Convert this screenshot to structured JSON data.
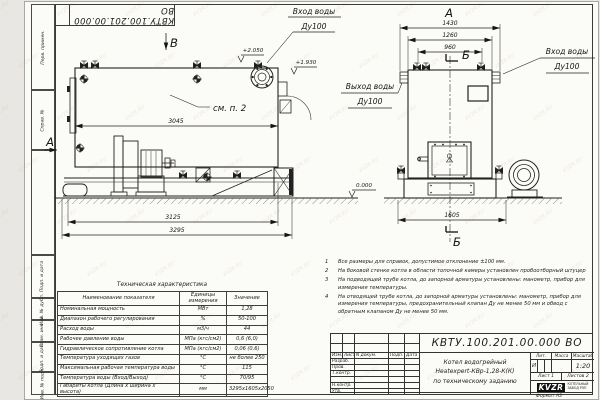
{
  "watermark": {
    "text": "KVZR.RU"
  },
  "frame": {
    "top_stamp": "КВТУ.100.201.00.000 ВО",
    "left_labels": [
      "Перв. примен.",
      "Справ. №",
      "Подп. и дата",
      "Инв. № дубл.",
      "Взам. инв. №",
      "Подп. и дата",
      "Инв. № подл."
    ],
    "format_label": "Формат А3"
  },
  "views": {
    "side": {
      "label_v": "В",
      "label_a": "А",
      "see_note": "см. п. 2",
      "dim_3045": "3045",
      "dim_3125": "3125",
      "dim_3295": "3295",
      "elev_top": "+2.050",
      "elev_mid": "+1.930",
      "elev_zero": "0.000",
      "inlet_line1": "Вход воды",
      "inlet_line2": "Ду100"
    },
    "end": {
      "label_a": "А",
      "label_b_top": "Б",
      "label_b_bottom": "Б",
      "dim_1430": "1430",
      "dim_1260": "1260",
      "dim_960": "960",
      "dim_1605": "1605",
      "inlet_line1": "Вход воды",
      "inlet_line2": "Ду100",
      "outlet_line1": "Выход воды",
      "outlet_line2": "Ду100"
    }
  },
  "table": {
    "title": "Техническая характеристика",
    "headers": [
      "Наименование показателя",
      "Единицы измерения",
      "Значение"
    ],
    "rows": [
      {
        "name": "Номинальная мощность",
        "unit": "МВт",
        "value": "1,28"
      },
      {
        "name": "Диапазон рабочего регулирования",
        "unit": "%",
        "value": "50-100"
      },
      {
        "name": "Расход воды",
        "unit": "м3/ч",
        "value": "44"
      },
      {
        "name": "Рабочее давление воды",
        "unit": "МПа (кгс/см2)",
        "value": "0,6 (6,0)"
      },
      {
        "name": "Гидравлическое сопротивление котла",
        "unit": "МПа (кгс/см2)",
        "value": "0,06 (0,6)"
      },
      {
        "name": "Температура уходящих газов",
        "unit": "°С",
        "value": "не более 250"
      },
      {
        "name": "Максимальная рабочая температура воды",
        "unit": "°С",
        "value": "115"
      },
      {
        "name": "Температура воды (Вход/Выход)",
        "unit": "°С",
        "value": "70/95"
      },
      {
        "name": "Габариты котла (Длина х ширина х высота)",
        "unit": "мм",
        "value": "3295х1605х2050"
      }
    ]
  },
  "notes": [
    {
      "num": "1",
      "text": "Все размеры для справок, допустимое отклонение ±100 мм."
    },
    {
      "num": "2",
      "text": "На боковой стенке котла в области топочной камеры установлен пробоотборный штуцер"
    },
    {
      "num": "3",
      "text": "На подводящей трубе котла, до запорной арматуры установлены: манометр, прибор для измерения температуры."
    },
    {
      "num": "4",
      "text": "На отводящей трубе котла, до запорной арматуры установлены: манометр, прибор для измерения температуры, предохранительный клапан Ду не менее 50 мм и обвод с обратным клапаном Ду не менее 50 мм."
    }
  ],
  "title_block": {
    "doc_number": "КВТУ.100.201.00.000  ВО",
    "name_line1": "Котел водогрейный",
    "name_line2": "Heatexpert-КВр-1,28-К(К)",
    "name_line3": "по техническому заданию",
    "header_row": [
      "Изм.",
      "Лист",
      "N докум.",
      "Подп.",
      "Дата"
    ],
    "row_labels": [
      "Разраб.",
      "Пров.",
      "Т.контр.",
      "",
      "Н.контр.",
      "Утв."
    ],
    "lit_header": "Лит.",
    "mass_header": "Масса",
    "scale_header": "Масштаб",
    "lit_value": "И",
    "scale_value": "1:20",
    "sheet_text": "Лист 1",
    "sheets_text": "Листов 2",
    "logo_text": "KVZR",
    "logo_caption_line1": "КОТЕЛЬНЫЙ",
    "logo_caption_line2": "ЗАВОД РЭП"
  }
}
